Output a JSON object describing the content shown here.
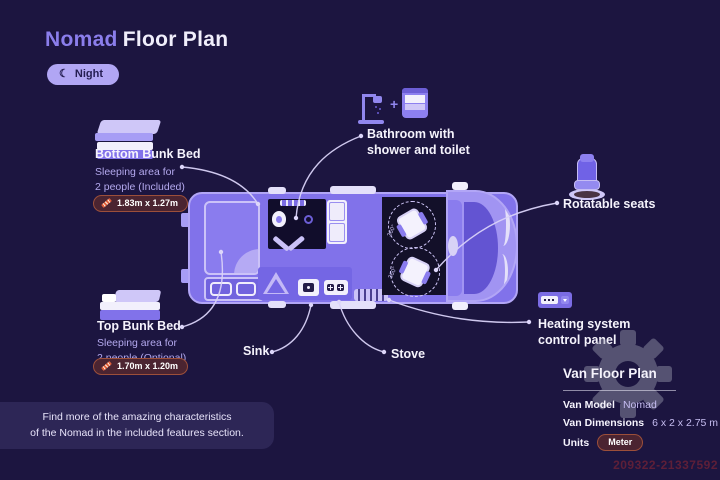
{
  "header": {
    "title_accent": "Nomad",
    "title_rest": "Floor Plan",
    "mode_toggle": {
      "icon": "moon-icon",
      "icon_glyph": "☾",
      "label": "Night"
    }
  },
  "callouts": {
    "bottom_bunk": {
      "title": "Bottom Bunk Bed",
      "subtitle": "Sleeping area for\n2 people (Included)",
      "dimension": "1.83m x 1.27m"
    },
    "top_bunk": {
      "title": "Top Bunk Bed",
      "subtitle": "Sleeping area for\n2 people (Optional)",
      "dimension": "1.70m x 1.20m"
    },
    "bathroom": {
      "label": "Bathroom with\nshower and toilet",
      "plus_glyph": "+"
    },
    "rotatable_seats": {
      "label": "Rotatable seats"
    },
    "heating": {
      "label": "Heating system\ncontrol panel"
    },
    "sink": {
      "label": "Sink"
    },
    "stove": {
      "label": "Stove"
    }
  },
  "van": {
    "seat_rotation_label": "360°"
  },
  "info_panel": {
    "title": "Van Floor Plan",
    "rows": [
      {
        "label": "Van Model",
        "value": "Nomad"
      },
      {
        "label": "Van Dimensions",
        "value": "6 x 2 x 2.75 m"
      },
      {
        "label": "Units",
        "value": "Meter"
      }
    ]
  },
  "footer_note": "Find more of the amazing characteristics\nof the Nomad in the included features section.",
  "watermark_id": "209322-21337592",
  "colors": {
    "background": "#1c1540",
    "accent_purple": "#8b7eec",
    "light_lavender": "#b1a6f4",
    "badge_maroon": "#4b2431",
    "badge_border": "#9c4f3a",
    "ruler_orange": "#e0603c",
    "text_white": "#f5f3fc"
  }
}
